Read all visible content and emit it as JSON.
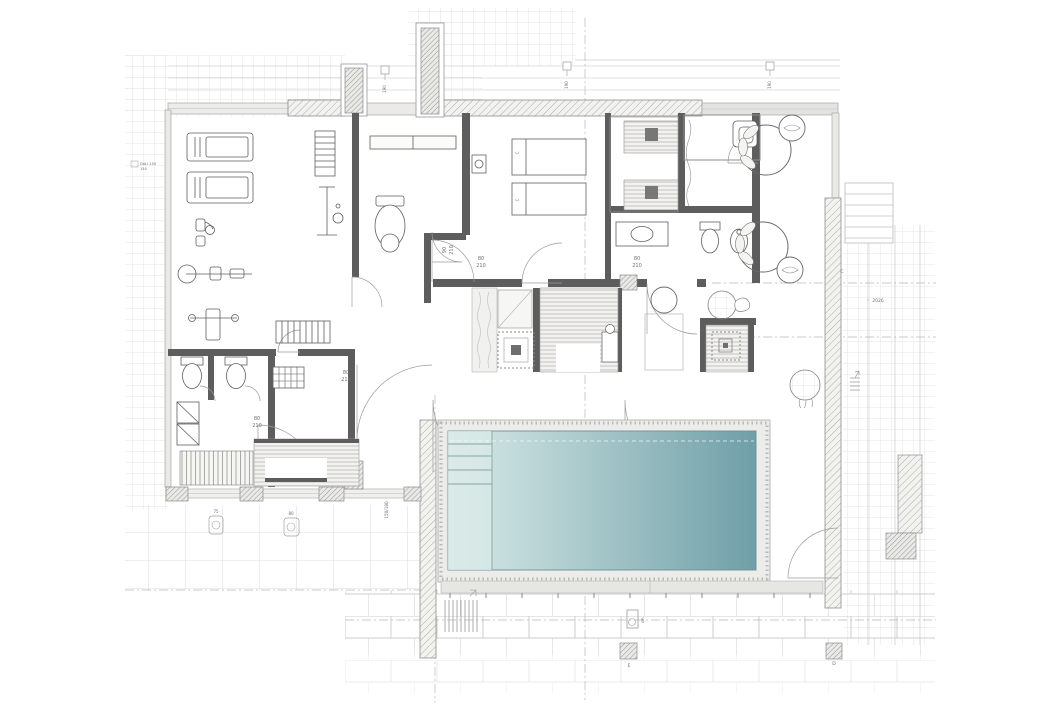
{
  "drawing": {
    "kind": "architectural floor plan with swimming pool, spa rooms, gym and terraces"
  },
  "colors": {
    "background": "#ffffff",
    "interior_wall": "#5d5d5d",
    "hatch_stroke": "#a8a8a8",
    "paving_grid": "#dcdcdc",
    "tile_line": "#cdcdcd",
    "pool_shallow": "#d8eae8",
    "pool_deep": "#6f9fa8",
    "pool_edge": "#7fa0a2",
    "deck_fill": "#ecedea",
    "furniture_stroke": "#5f5f5f",
    "annotation_text": "#787878"
  },
  "annotations": {
    "dali_tag": {
      "line1": "DALI 150",
      "line2": "150"
    },
    "door_tags": [
      {
        "w": "80",
        "h": "210"
      },
      {
        "w": "80",
        "h": "210"
      },
      {
        "w": "80",
        "h": "210"
      },
      {
        "w": "80",
        "h": "210"
      }
    ],
    "vestibule_door_tag": {
      "w": "90",
      "h": "210"
    },
    "window_tag": "150/180",
    "level_tag": "2026",
    "level_arrow": "‹",
    "grid_letter_c": "C",
    "grid_letter_e": "E",
    "grid_letter_d": "D",
    "light_tags": [
      "190",
      "190",
      "190"
    ],
    "drain_tags": [
      "75",
      "80"
    ],
    "pool_drain_tag": "ØR",
    "massage_table_tags": [
      "C",
      "C"
    ]
  }
}
